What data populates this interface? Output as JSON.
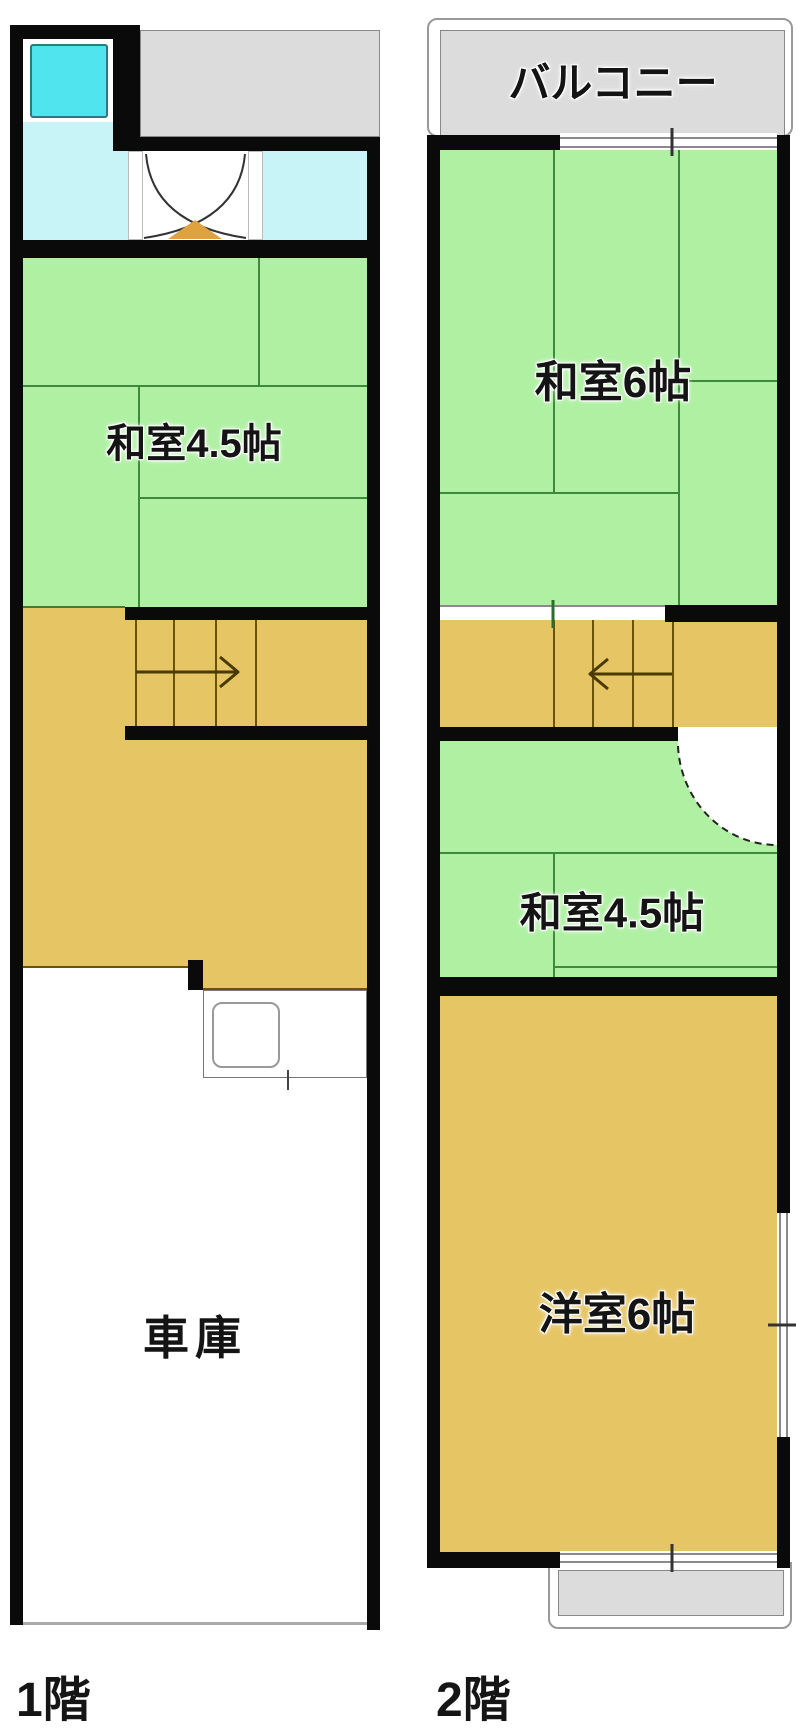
{
  "floor1": {
    "caption": "1階",
    "rooms": {
      "washitsu45": {
        "label": "和室4.5帖"
      },
      "garage": {
        "label": "車庫"
      }
    }
  },
  "floor2": {
    "caption": "2階",
    "balcony": {
      "label": "バルコニー"
    },
    "rooms": {
      "washitsu6": {
        "label": "和室6帖"
      },
      "washitsu45": {
        "label": "和室4.5帖"
      },
      "youshitsu6": {
        "label": "洋室6帖"
      }
    }
  },
  "colors": {
    "wall_black": "#0a0a0a",
    "tatami_green": "#aff0a3",
    "tatami_line": "#3d8a3d",
    "wood_tan": "#e6c565",
    "stair_line": "#6b5300",
    "bath_cyan": "#50e5ee",
    "washroom_cyan": "#c9f4f7",
    "balcony_gray": "#dcdcdc",
    "threshold_orange": "#e0a23e"
  }
}
